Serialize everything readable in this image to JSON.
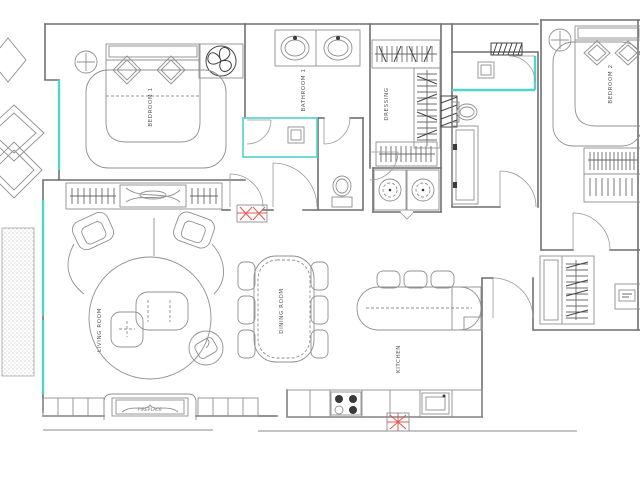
{
  "plan": {
    "type": "apartment-floor-plan",
    "colors": {
      "background": "#ffffff",
      "wall_line": "#6f6f6f",
      "furniture_line": "#909090",
      "window_teal": "#54d2cb",
      "radiator_red": "#e25850",
      "label_text": "#5a5a5a"
    },
    "rooms": {
      "bedroom1": {
        "label": "BEDROOM 1",
        "fixtures": [
          "double-bed",
          "pillows",
          "nightstand-lamp",
          "ceiling-fan",
          "rug",
          "wardrobe-with-hangers"
        ]
      },
      "bathroom1": {
        "label": "BATHROOM 1",
        "fixtures": [
          "double-sink-vanity",
          "shower-enclosure",
          "wc-toilet"
        ]
      },
      "dressing": {
        "label": "DRESSING",
        "fixtures": [
          "hanging-closets",
          "washer",
          "dryer"
        ]
      },
      "bathroom2": {
        "fixtures": [
          "shower-enclosure",
          "toilet",
          "vanity-counter"
        ]
      },
      "bedroom2": {
        "label": "BEDROOM 2",
        "fixtures": [
          "double-bed",
          "pillows",
          "nightstand-lamp",
          "rug",
          "closet-with-hangers"
        ]
      },
      "living": {
        "label": "LIVING ROOM",
        "fixtures": [
          "curved-sofa",
          "armchair",
          "armchair",
          "coffee-table",
          "side-table",
          "swivel-chair",
          "round-rug",
          "fireplace",
          "cabinets"
        ]
      },
      "dining": {
        "label": "DINING ROOM",
        "fixtures": [
          "dining-table",
          "six-chairs"
        ]
      },
      "kitchen": {
        "label": "KITCHEN",
        "fixtures": [
          "island-with-bar",
          "bar-stools-x3",
          "cooktop-4-burner",
          "kitchen-sink",
          "base-counter"
        ]
      },
      "hall": {
        "fixtures": [
          "wardrobe-with-hangers",
          "desk",
          "radiator"
        ]
      }
    },
    "fireplace_label": "FIREPLACE",
    "annotations": {
      "windows": "teal glazing lines on left and in showers",
      "radiators": "red cross-hatched heater symbols",
      "exterior": "decorative diamonds and stippled planter outside left wall"
    }
  }
}
